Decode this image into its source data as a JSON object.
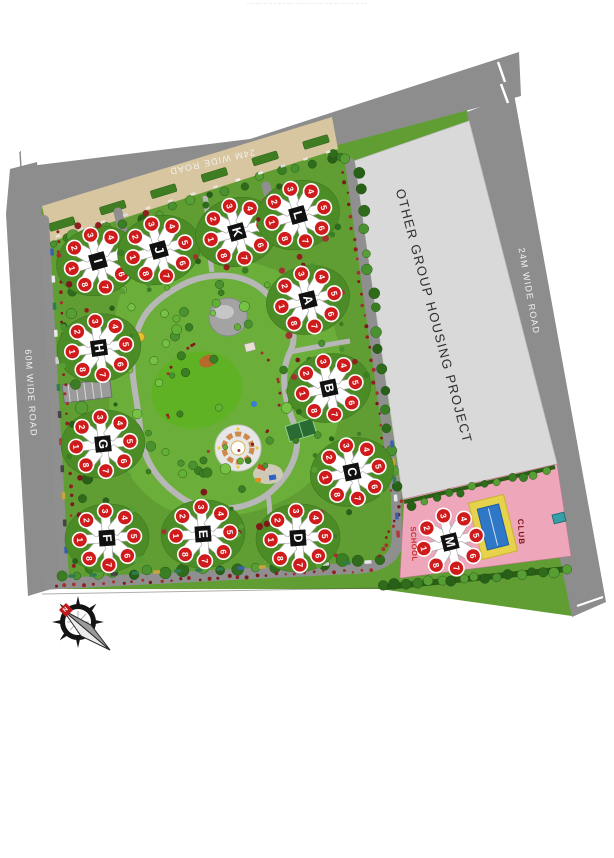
{
  "page": {
    "fine_print": "· ··· ····· ···· ··· ·· ······ ···· · ····· ··· ···· ·· ··· · ····· ···· ··· ·· ···· ··· ·····"
  },
  "map": {
    "roads": {
      "top": {
        "label": "24M WIDE ROAD"
      },
      "right": {
        "label": "24M WIDE ROAD"
      },
      "left": {
        "label": "60M WIDE ROAD"
      }
    },
    "adjacent_project": {
      "label": "OTHER GROUP HOUSING PROJECT"
    },
    "facilities": {
      "school": {
        "label": "SCHOOL"
      },
      "club": {
        "label": "CLUB"
      }
    },
    "compass": {
      "north_label": "N"
    },
    "tower_unit_numbers": [
      "1",
      "2",
      "3",
      "4",
      "5",
      "6",
      "7",
      "8"
    ],
    "towers": [
      {
        "label": "I",
        "x": 98,
        "y": 261,
        "rot": -16
      },
      {
        "label": "J",
        "x": 159,
        "y": 250,
        "rot": -16
      },
      {
        "label": "K",
        "x": 237,
        "y": 232,
        "rot": -16
      },
      {
        "label": "L",
        "x": 298,
        "y": 215,
        "rot": -16
      },
      {
        "label": "A",
        "x": 308,
        "y": 300,
        "rot": -14
      },
      {
        "label": "B",
        "x": 329,
        "y": 388,
        "rot": -12
      },
      {
        "label": "C",
        "x": 352,
        "y": 472,
        "rot": -12
      },
      {
        "label": "H",
        "x": 99,
        "y": 348,
        "rot": -8
      },
      {
        "label": "G",
        "x": 103,
        "y": 444,
        "rot": -6
      },
      {
        "label": "F",
        "x": 107,
        "y": 538,
        "rot": -4
      },
      {
        "label": "E",
        "x": 203,
        "y": 534,
        "rot": -4
      },
      {
        "label": "D",
        "x": 298,
        "y": 538,
        "rot": -4
      },
      {
        "label": "M",
        "x": 450,
        "y": 542,
        "rot": -14
      }
    ],
    "colors": {
      "road": "#8d8d8d",
      "road_text": "#f0f0f0",
      "site_green": "#609e34",
      "park_green": "#6cae3a",
      "project_fill": "#d9d9da",
      "school_pink": "#eda6ba",
      "badge_red": "#cf1b1b",
      "tower_core": "#111111",
      "building_white": "#ffffff",
      "pool_blue": "#2f78c8",
      "pool_deck": "#e6d24b",
      "parking_tan": "#d8c6a0",
      "school_text": "#cf2b2b",
      "club_text": "#7c1518"
    }
  }
}
